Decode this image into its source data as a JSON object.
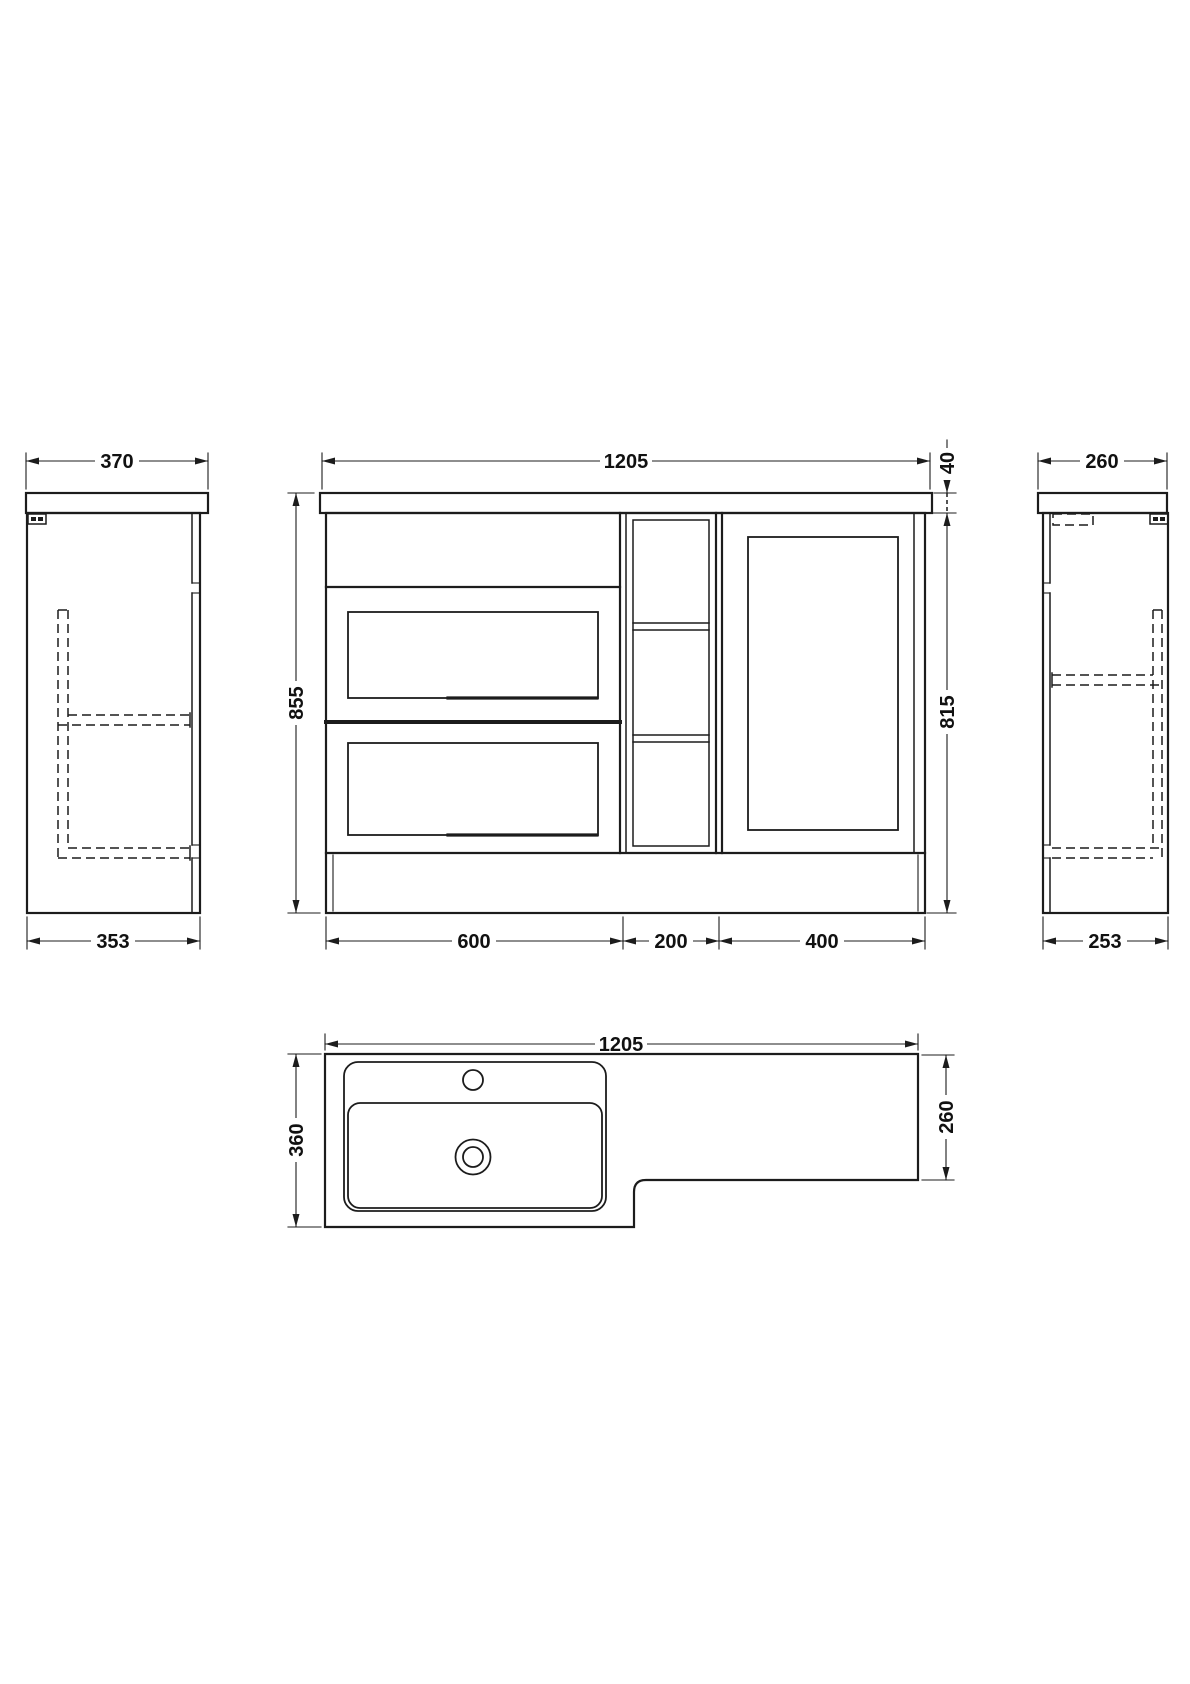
{
  "drawing_title": "L-shaped bathroom vanity unit dimension drawing",
  "colors": {
    "line": "#1c1c1c",
    "background": "#ffffff"
  },
  "dims": {
    "front_width": "1205",
    "worktop_thickness": "40",
    "total_height": "855",
    "cabinet_height": "815",
    "basin_unit_width": "600",
    "mid_unit_width": "200",
    "wc_unit_width": "400",
    "left_worktop_depth": "370",
    "left_cabinet_depth": "353",
    "right_worktop_depth": "260",
    "right_cabinet_depth": "253",
    "plan_width": "1205",
    "plan_left_depth": "360",
    "plan_right_depth": "260"
  }
}
